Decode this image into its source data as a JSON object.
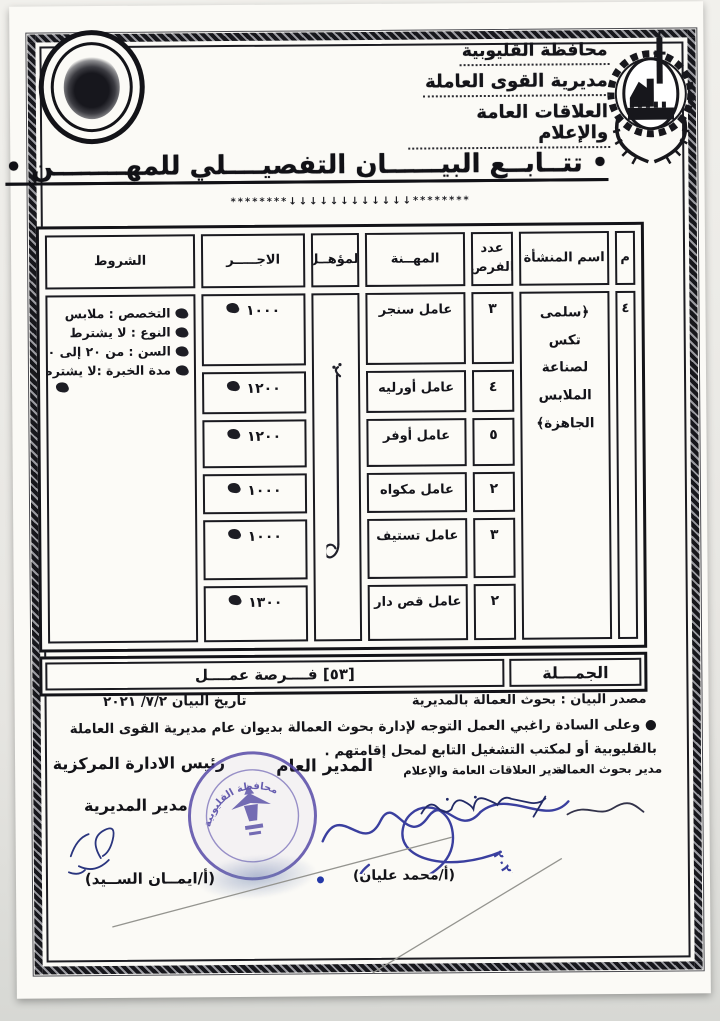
{
  "document": {
    "org": {
      "lines": [
        "محافظة القليوبية",
        "مديرية القوى العاملة",
        "العلاقات العامة والإعلام"
      ]
    },
    "title": {
      "text": "• تتــابــع البيــــــان التفصيــــلي للمهــــــــن •",
      "ornament": "********↓↓↓↓↓↓↓↓↓↓↓↓********"
    },
    "table": {
      "headers": {
        "serial": "م",
        "establishment": "اسم المنشأة",
        "openings": "عدد الفرص",
        "profession": "المهــنة",
        "qualification": "المؤهــل",
        "wage": "الاجـــــر",
        "conditions": "الشروط"
      },
      "serial_value": "٤",
      "establishment_value": "﴿سلمى تكس لصناعة الملابس الجاهزة﴾",
      "rows": [
        {
          "profession": "عامل سنجر",
          "openings": "٣",
          "wage": "١٠٠٠"
        },
        {
          "profession": "عامل أورليه",
          "openings": "٤",
          "wage": "١٢٠٠"
        },
        {
          "profession": "عامل أوفر",
          "openings": "٥",
          "wage": "١٢٠٠"
        },
        {
          "profession": "عامل مكواه",
          "openings": "٢",
          "wage": "١٠٠٠"
        },
        {
          "profession": "عامل تستيف",
          "openings": "٣",
          "wage": "١٠٠٠"
        },
        {
          "profession": "عامل قص دار",
          "openings": "٢",
          "wage": "١٣٠٠"
        }
      ],
      "conditions": [
        "التخصص : ملابس",
        "النوع : لا يشترط",
        "السن : من ٢٠ إلى ٣٠",
        "مدة الخبرة :لا يشترط"
      ],
      "total_label": "الجمـــلة",
      "total_value": "[٥٣] فــــرصة عمــــل"
    },
    "footer": {
      "source": "مصدر البيان : بحوث العمالة بالمديرية",
      "date": "تاريخ البيان ٧/٢/ ٢٠٢١",
      "note": "● وعلى السادة راغبي العمل التوجه لإدارة بحوث العمالة بديوان عام مديرية القوى العاملة بالقليوبية أو لمكتب التشغيل التابع لمحل إقامتهم ."
    },
    "signatures": {
      "labor_research": "مدير بحوث العمالة",
      "pr_media": "مدير العلاقات العامة والإعلام",
      "general_manager": "المدير العام",
      "central_admin": "رئيس الادارة المركزية",
      "directorate_manager": "مدير المديرية",
      "name_right": "(أ/محمد عليان)",
      "name_left": "(أ/ايمــان الســيد)",
      "stamp_text": "محافظة القليوبية",
      "year": "٢٠٢١"
    }
  }
}
